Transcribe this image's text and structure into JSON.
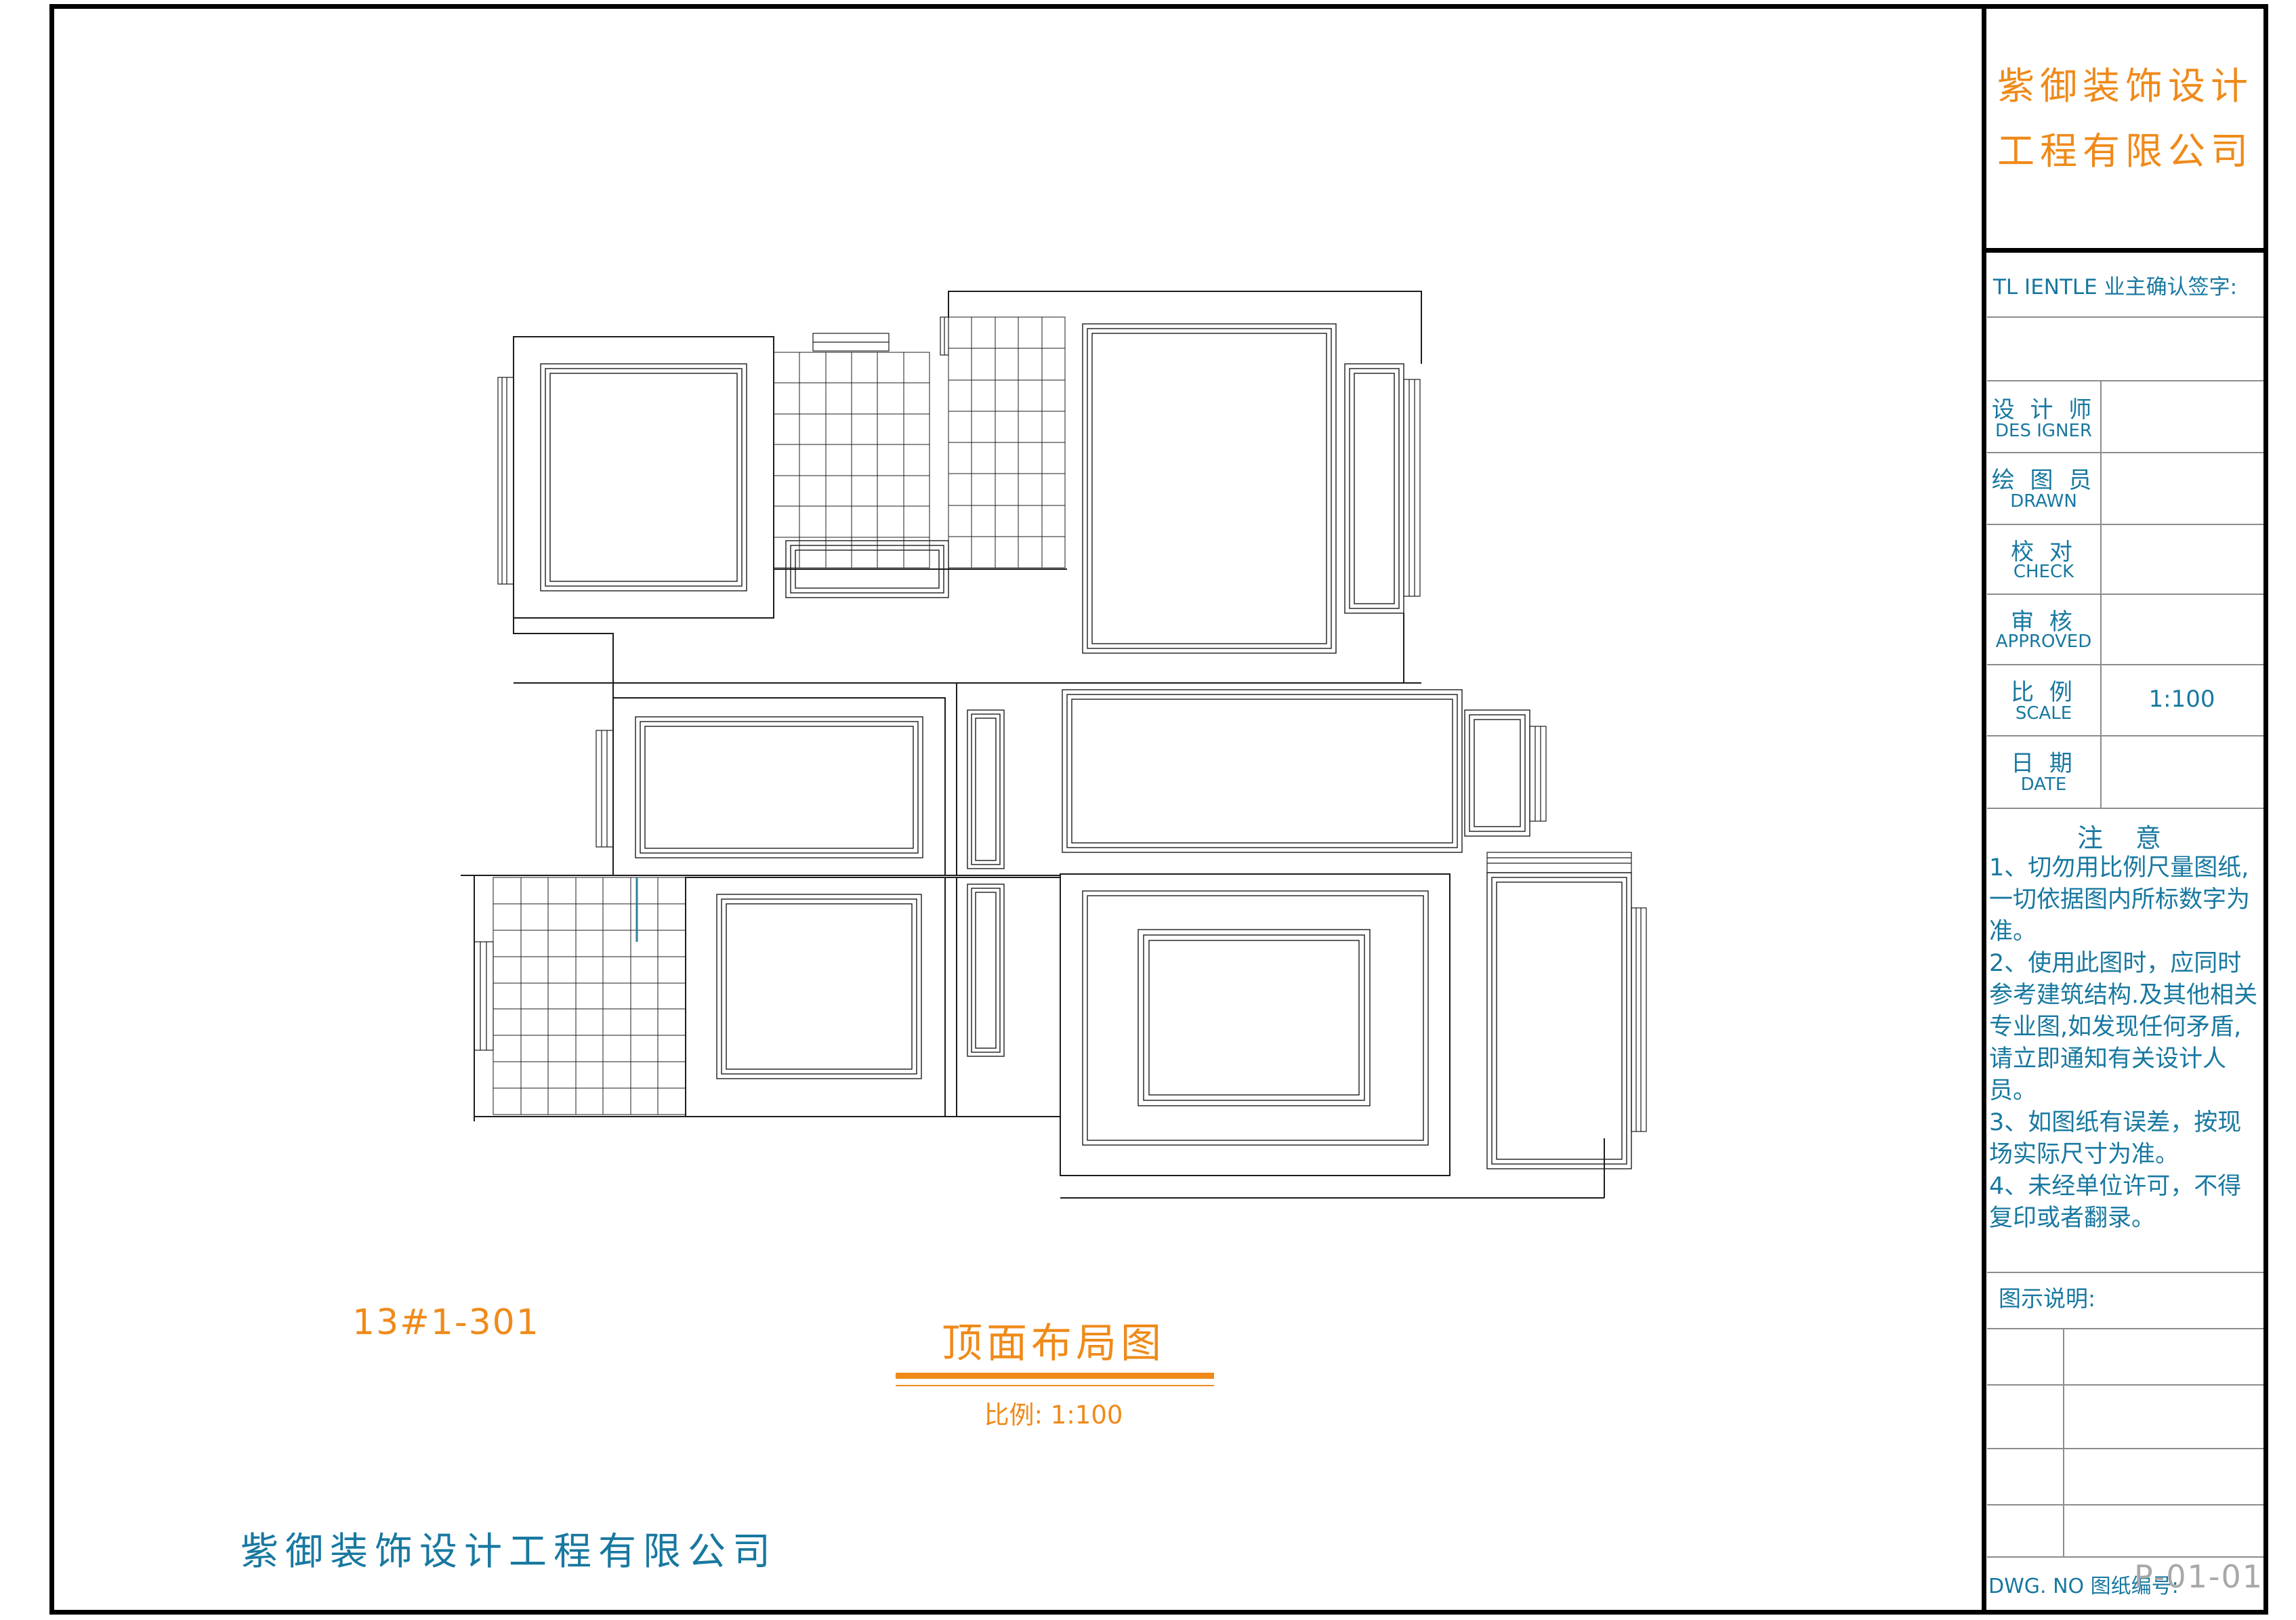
{
  "title_block": {
    "company_name_line1": "紫御装饰设计",
    "company_name_line2": "工程有限公司",
    "client_sign_label": "TL IENTLE 业主确认签字:",
    "rows": [
      {
        "zh": "设 计 师",
        "en": "DES IGNER",
        "value": ""
      },
      {
        "zh": "绘 图 员",
        "en": "DRAWN",
        "value": ""
      },
      {
        "zh": "校   对",
        "en": "CHECK",
        "value": ""
      },
      {
        "zh": "审   核",
        "en": "APPROVED",
        "value": ""
      },
      {
        "zh": "比   例",
        "en": "SCALE",
        "value": "1:100"
      },
      {
        "zh": "日   期",
        "en": "DATE",
        "value": ""
      }
    ],
    "notes_title": "注 意",
    "notes": [
      "1、切勿用比例尺量图纸,一切依据图内所标数字为准。",
      "2、使用此图时，应同时参考建筑结构.及其他相关专业图,如发现任何矛盾,请立即通知有关设计人员。",
      "3、如图纸有误差，按现场实际尺寸为准。",
      "4、未经单位许可，不得复印或者翻录。"
    ],
    "legend_label": "图示说明:",
    "dwg_label": "DWG. NO 图纸编号:",
    "dwg_number": "P-01-01"
  },
  "drawing": {
    "unit_label": "13#1-301",
    "title": "顶面布局图",
    "scale_label": "比例: 1:100",
    "footer_company": "紫御装饰设计工程有限公司",
    "type": "ceiling layout plan (顶面布局图), CAD line drawing, scale 1:100"
  },
  "colors": {
    "accent_orange": "#ef8a1a",
    "text_teal": "#1878a0",
    "dwg_number_gray": "#a8a8a8",
    "drawing_lines": "#1c1c1c",
    "teal_accent_line": "#2e7f9e",
    "titleblock_grid_gray": "#8c8c8c",
    "page_border_black": "#000000"
  }
}
